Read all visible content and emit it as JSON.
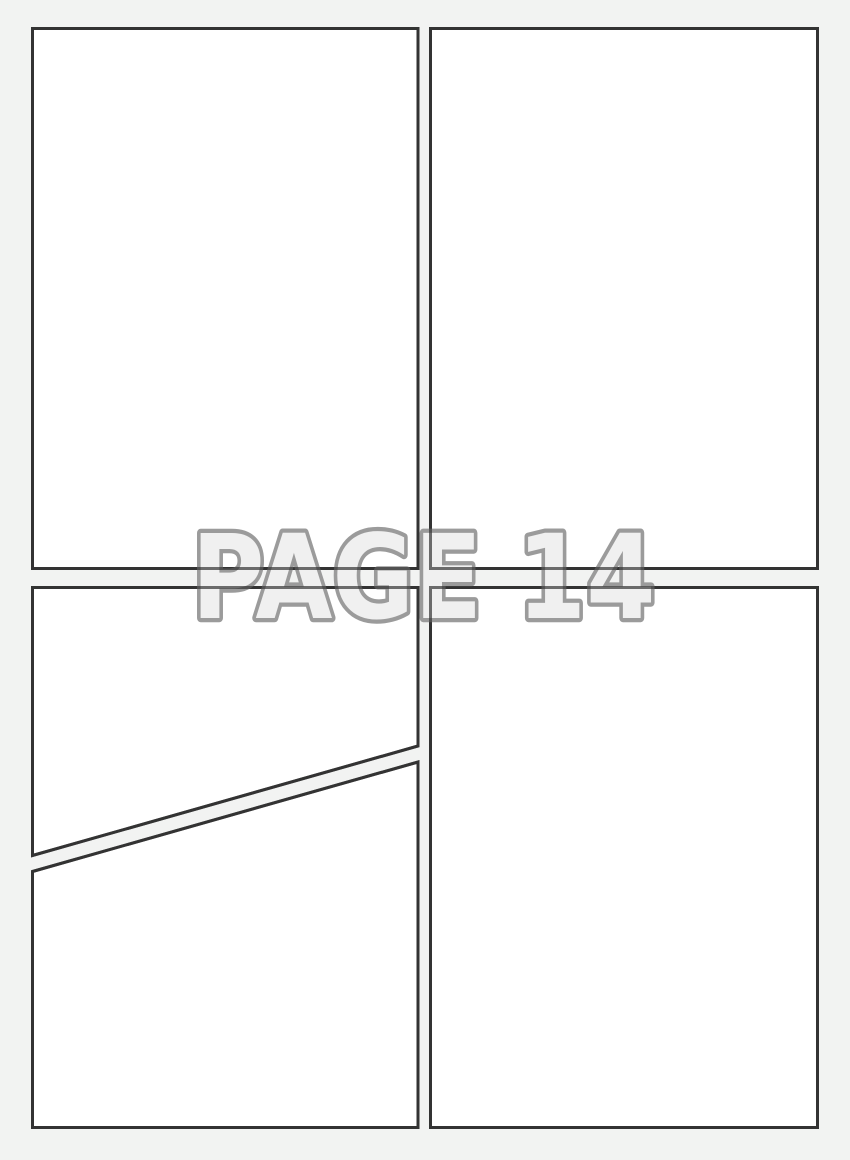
{
  "page": {
    "label": "PAGE 14",
    "background_color": "#f2f3f2",
    "panel_fill": "#ffffff",
    "panel_border_color": "#333333",
    "label_fill": "#f0f0f0",
    "label_outline_color": "#9b9b9b"
  }
}
